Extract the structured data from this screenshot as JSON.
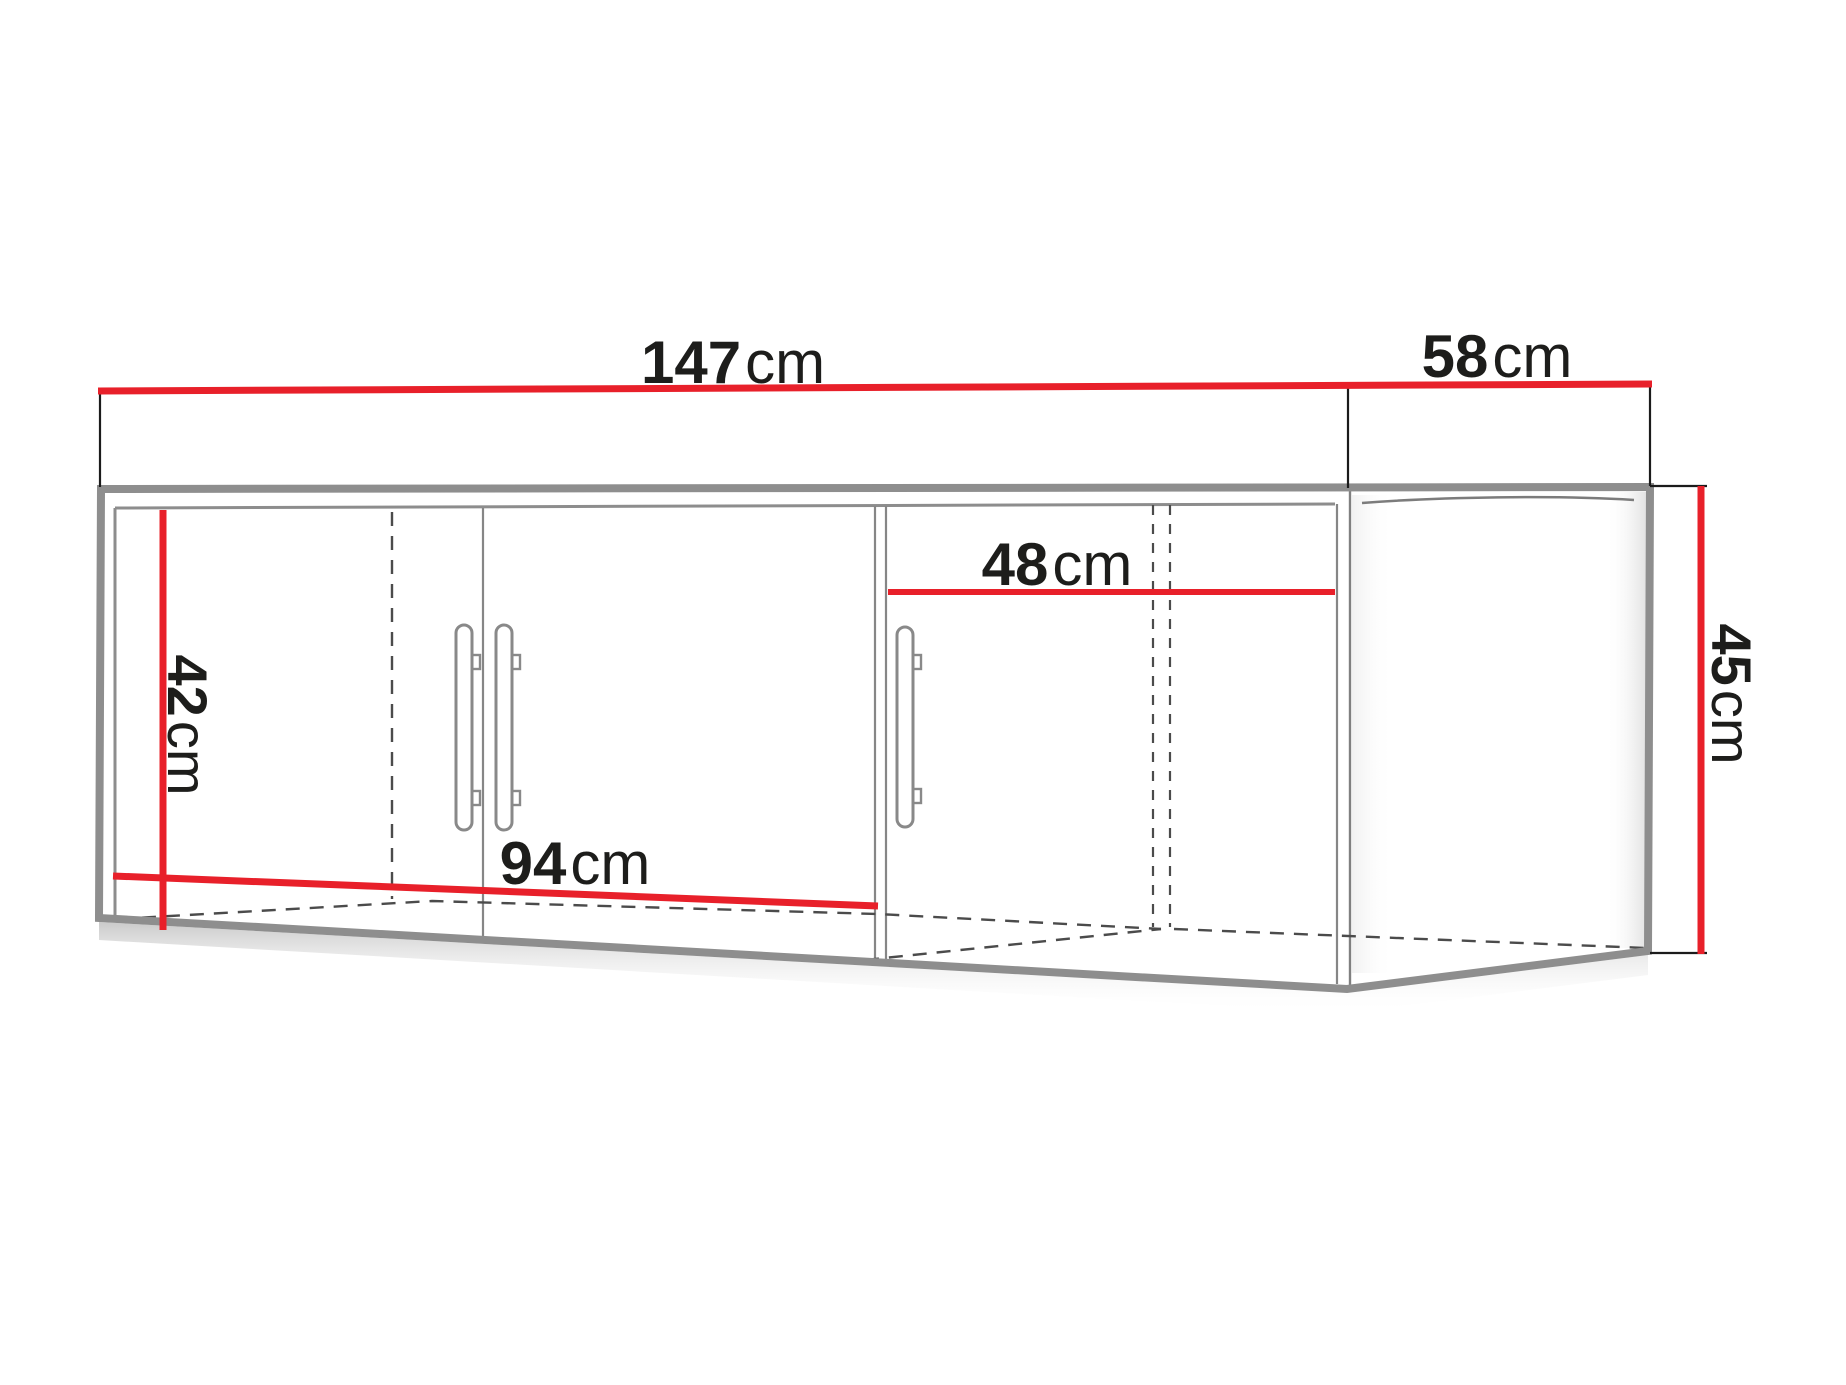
{
  "diagram": {
    "subject": "corner-wall-cabinet-dimension-drawing",
    "colors": {
      "dimension_line": "#e8202a",
      "cabinet_outline": "#8e8e8e",
      "hidden_line": "#4b4b4b",
      "extension_line": "#1b1b1b",
      "label_text": "#1d1d1b",
      "background": "#ffffff"
    },
    "dimensions": {
      "front_width": {
        "num": "147",
        "unit": "cm"
      },
      "side_depth": {
        "num": "58",
        "unit": "cm"
      },
      "inner_width": {
        "num": "48",
        "unit": "cm"
      },
      "left_height": {
        "num": "42",
        "unit": "cm"
      },
      "doors_width": {
        "num": "94",
        "unit": "cm"
      },
      "side_height": {
        "num": "45",
        "unit": "cm"
      }
    }
  }
}
